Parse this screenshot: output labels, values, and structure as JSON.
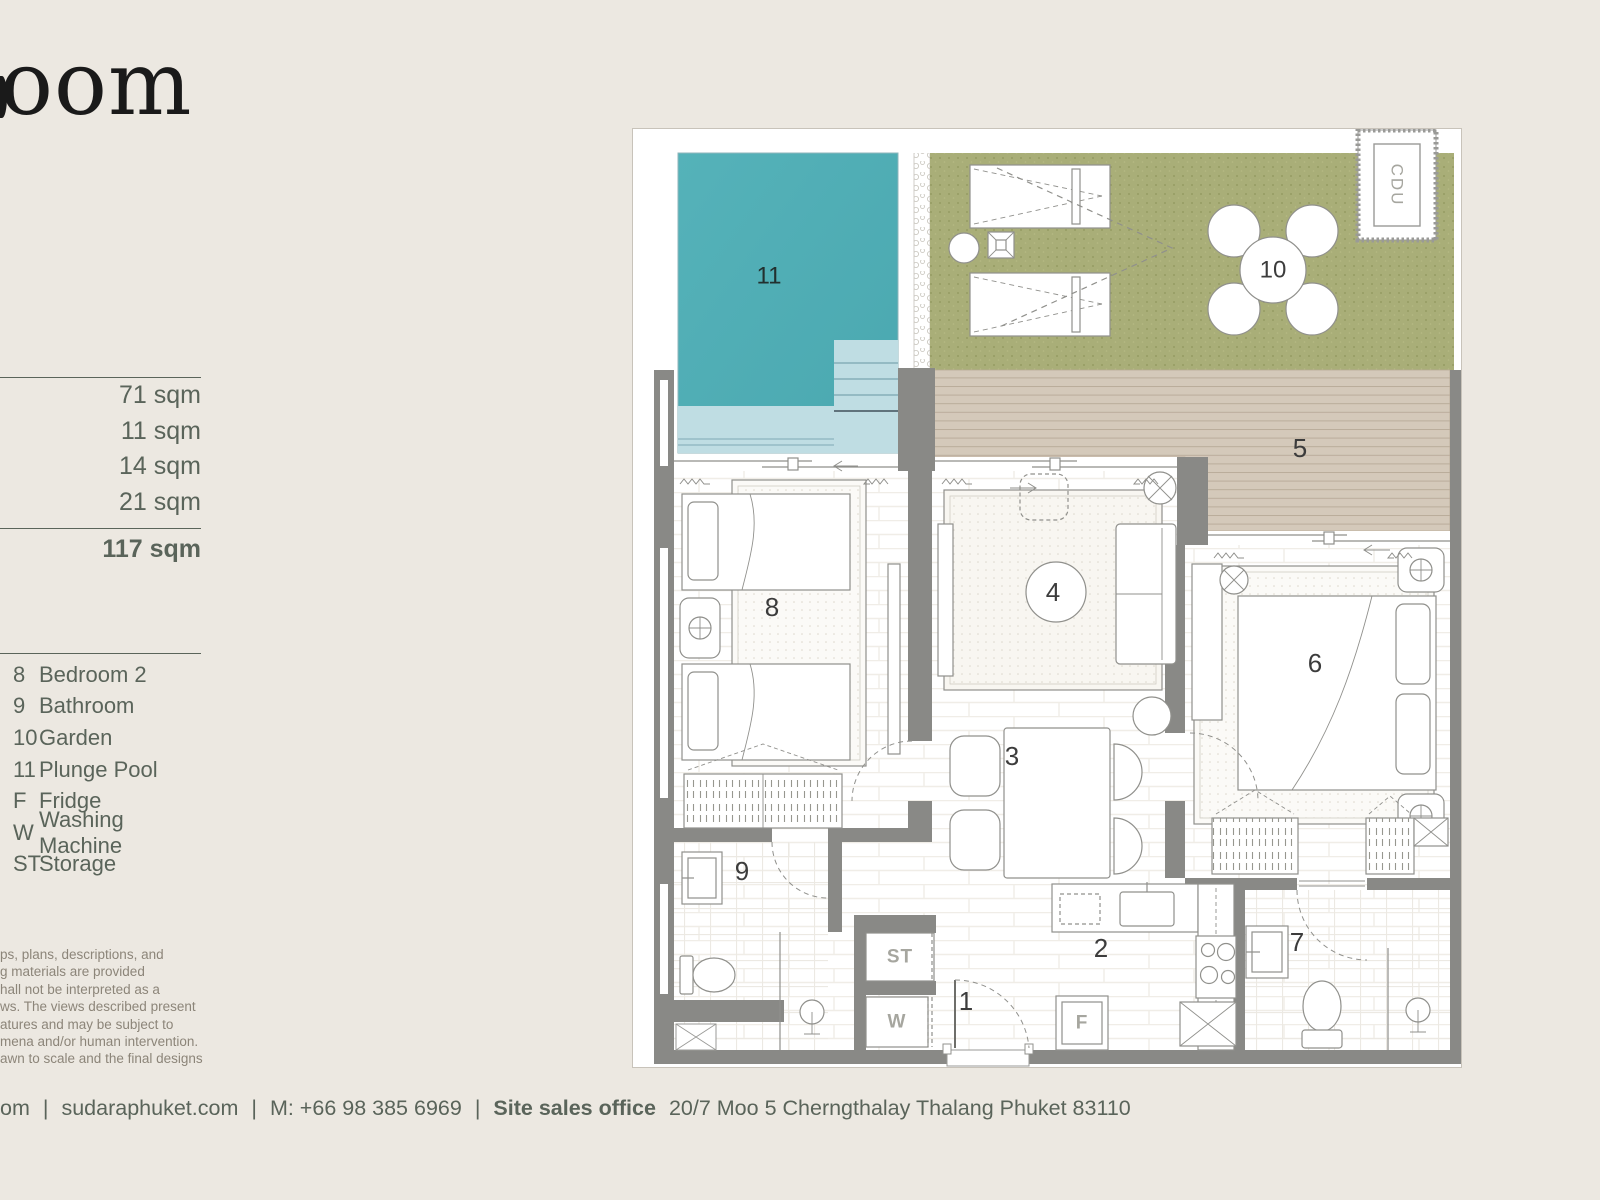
{
  "brand": {
    "logo_fragment": "oom"
  },
  "areas": {
    "items": [
      {
        "value": "71 sqm"
      },
      {
        "value": "11 sqm"
      },
      {
        "value": "14 sqm"
      },
      {
        "value": "21 sqm"
      }
    ],
    "total": "117 sqm"
  },
  "legend": {
    "items": [
      {
        "key": "8",
        "label": "Bedroom 2"
      },
      {
        "key": "9",
        "label": "Bathroom"
      },
      {
        "key": "10",
        "label": "Garden"
      },
      {
        "key": "11",
        "label": "Plunge Pool"
      },
      {
        "key": "F",
        "label": "Fridge"
      },
      {
        "key": "W",
        "label": "Washing Machine"
      },
      {
        "key": "ST",
        "label": "Storage"
      }
    ]
  },
  "disclaimer": {
    "lines": [
      "ps, plans, descriptions,  and",
      "g materials are provided",
      "hall not be interpreted as a",
      "ws. The views described present",
      "atures and may be subject to",
      "mena and/or human intervention.",
      "awn to scale and the final designs"
    ]
  },
  "footer": {
    "fragment": "om",
    "separator": "|",
    "website": "sudaraphuket.com",
    "mobile": "M: +66 98 385 6969",
    "office_label": "Site sales office",
    "office_address": "20/7 Moo 5 Cherngthalay Thalang Phuket 83110"
  },
  "plan": {
    "rooms": {
      "entrance": "1",
      "kitchen": "2",
      "dining": "3",
      "living": "4",
      "terrace_deck": "5",
      "bedroom_1": "6",
      "bathroom_2": "7",
      "bedroom_2": "8",
      "bathroom_1": "9",
      "garden": "10",
      "plunge_pool": "11",
      "storage": "ST",
      "washing_machine": "W",
      "fridge": "F",
      "cdu": "CDU"
    },
    "colors": {
      "pool": "#4FAEB5",
      "pool_light": "#BFDDE3",
      "garden": "#A9AE78",
      "deck": "#D4C9BA",
      "wall": "#898986",
      "accent_text": "#5A645A"
    }
  }
}
